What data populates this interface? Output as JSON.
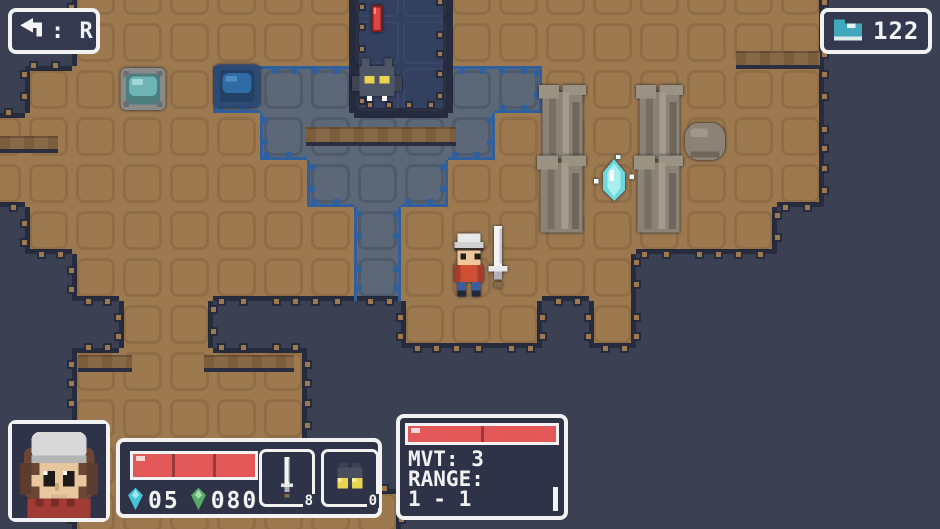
{
  "colors": {
    "background": "#3b4053",
    "floor": "#9d7950",
    "highlighted_floor": "#5c6877",
    "pit": "#344060",
    "edge_outline": "#262b3d",
    "range_border": "#2f5f9c",
    "hp_red": "#e25858",
    "ui_white": "#f2f2f2",
    "panel_fill": "#2f3347",
    "gem_cyan": "#45c4d6",
    "gem_green": "#55aa66",
    "boot_teal": "#3fa8bc"
  },
  "ui": {
    "undo_hint": {
      "icon": "undo-arrow-icon",
      "label": ": R"
    },
    "steps_counter": {
      "icon": "boot-icon",
      "value": "122"
    }
  },
  "party": {
    "portrait_icon": "hero-portrait",
    "hp": {
      "segments": 3
    },
    "currencies": [
      {
        "icon": "gem-cyan-icon",
        "value": "05"
      },
      {
        "icon": "gem-green-icon",
        "value": "080"
      }
    ],
    "inventory_slots": [
      {
        "icon": "sword-item-icon",
        "badge": "8"
      },
      {
        "icon": "binoculars-item-icon",
        "badge": "0"
      }
    ]
  },
  "enemy_panel": {
    "hp": {
      "segments": 2
    },
    "lines": [
      "MVT: 3",
      "RANGE:",
      "1 - 1"
    ]
  },
  "map": {
    "tile_size": 47,
    "origin": [
      -22,
      -28
    ],
    "legend": {
      "B": "background",
      "F": "floor",
      "T": "enemy-range-floor",
      "P": "pit"
    },
    "rows": [
      "BBFFFFFFPPFFFFFFFFBBB",
      "BBFFFFFFPPFFFFFFFFBBB",
      "BFFFFTTTPPTTFFFFFFBBB",
      "FFFFFFTTTTTFFFFFFFBBB",
      "FFFFFFFTTTFFFFFFFFBBB",
      "BFFFFFFFTFFFFFFFFBBBB",
      "BBFFFFFFTFFFFFBBBBBBB",
      "BBBFFBBBBFFFBFBBBBBBB",
      "BBFFFFFBBBBBBBBBBBBBB",
      "BBFFFFFBBBBBBBBBBBBBB",
      "BBFFFFFBBBBBBBBBBBBBB",
      "BBFFFFFFFBBBBBBBBBBBB"
    ]
  },
  "ledges": [
    {
      "x": 0,
      "y": 136,
      "w": 58,
      "h": 13
    },
    {
      "x": 306,
      "y": 127,
      "w": 150,
      "h": 15
    },
    {
      "x": 78,
      "y": 355,
      "w": 54,
      "h": 13
    },
    {
      "x": 204,
      "y": 355,
      "w": 90,
      "h": 13
    },
    {
      "x": 736,
      "y": 51,
      "w": 84,
      "h": 14
    }
  ],
  "sprites": [
    {
      "type": "red-marker",
      "x": 371,
      "y": 5,
      "w": 12,
      "h": 27,
      "interactable": false
    },
    {
      "type": "bat-enemy",
      "x": 352,
      "y": 58,
      "w": 50,
      "h": 46,
      "interactable": true
    },
    {
      "type": "pool-gray",
      "x": 120,
      "y": 68,
      "w": 46,
      "h": 42,
      "interactable": true
    },
    {
      "type": "pool-blue",
      "x": 214,
      "y": 64,
      "w": 46,
      "h": 44,
      "interactable": true
    },
    {
      "type": "pillar",
      "x": 539,
      "y": 84,
      "w": 47,
      "h": 76,
      "interactable": false
    },
    {
      "type": "pillar",
      "x": 537,
      "y": 154,
      "w": 49,
      "h": 80,
      "interactable": false
    },
    {
      "type": "pillar",
      "x": 636,
      "y": 84,
      "w": 47,
      "h": 76,
      "interactable": false
    },
    {
      "type": "pillar",
      "x": 634,
      "y": 154,
      "w": 49,
      "h": 80,
      "interactable": false
    },
    {
      "type": "crystal",
      "x": 592,
      "y": 152,
      "w": 44,
      "h": 54,
      "interactable": true
    },
    {
      "type": "boulder",
      "x": 682,
      "y": 115,
      "w": 46,
      "h": 50,
      "interactable": false
    },
    {
      "type": "sword-ground",
      "x": 486,
      "y": 226,
      "w": 24,
      "h": 64,
      "interactable": true
    },
    {
      "type": "player-hero",
      "x": 449,
      "y": 233,
      "w": 40,
      "h": 64,
      "interactable": true
    }
  ]
}
